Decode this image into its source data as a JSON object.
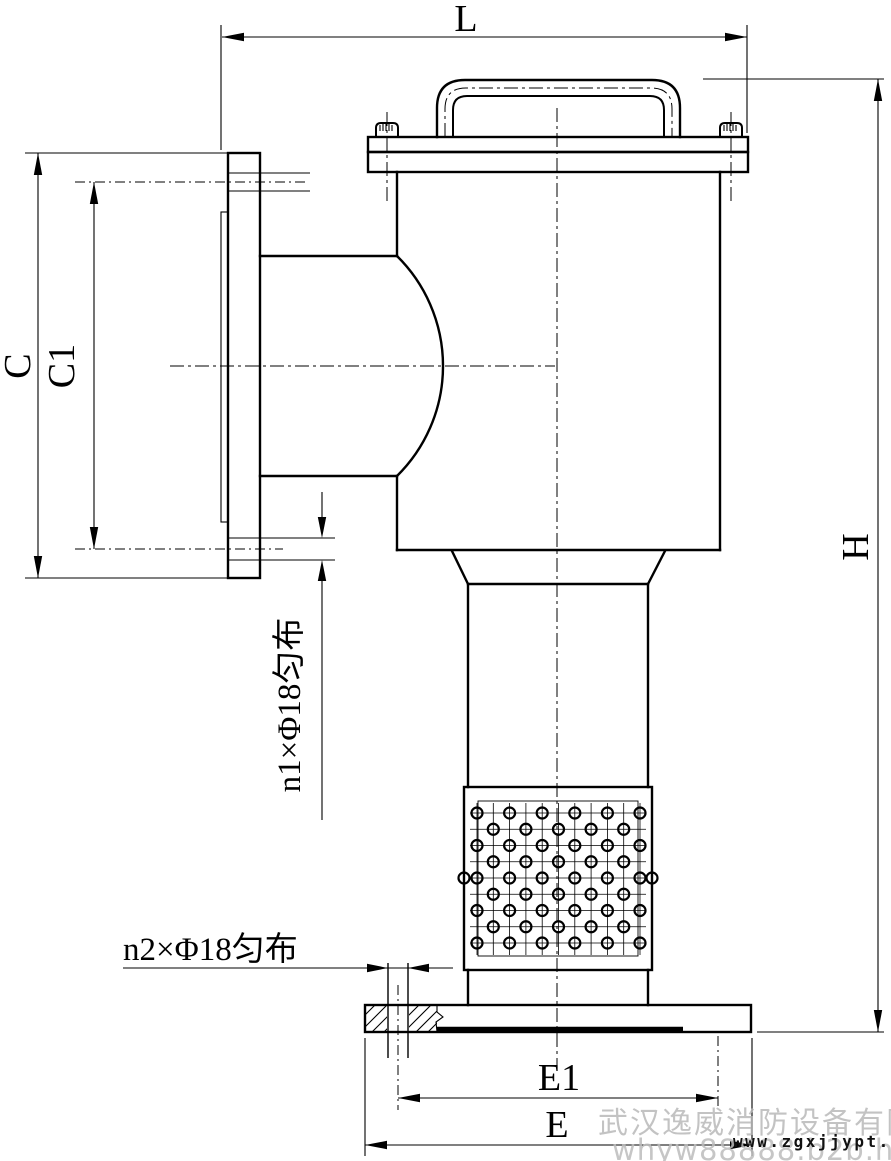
{
  "dimension_labels": {
    "length": "L",
    "side_flange_od": "C",
    "side_flange_bolt_circle": "C1",
    "total_height": "H",
    "base_bolt_circle": "E1",
    "base_flange_od": "E"
  },
  "annotations": {
    "side_flange_holes": "n1×Φ18匀布",
    "base_flange_holes": "n2×Φ18匀布"
  },
  "watermarks": {
    "company": "武汉逸威消防设备有限公司",
    "site_url": "www.zgxjjypt.com",
    "member_url": "whyw88888.b2b.hc360.com"
  },
  "colors": {
    "line": "#000000",
    "background": "#ffffff",
    "watermark_gray": "#b5b5b5",
    "url_text": "#111111"
  }
}
